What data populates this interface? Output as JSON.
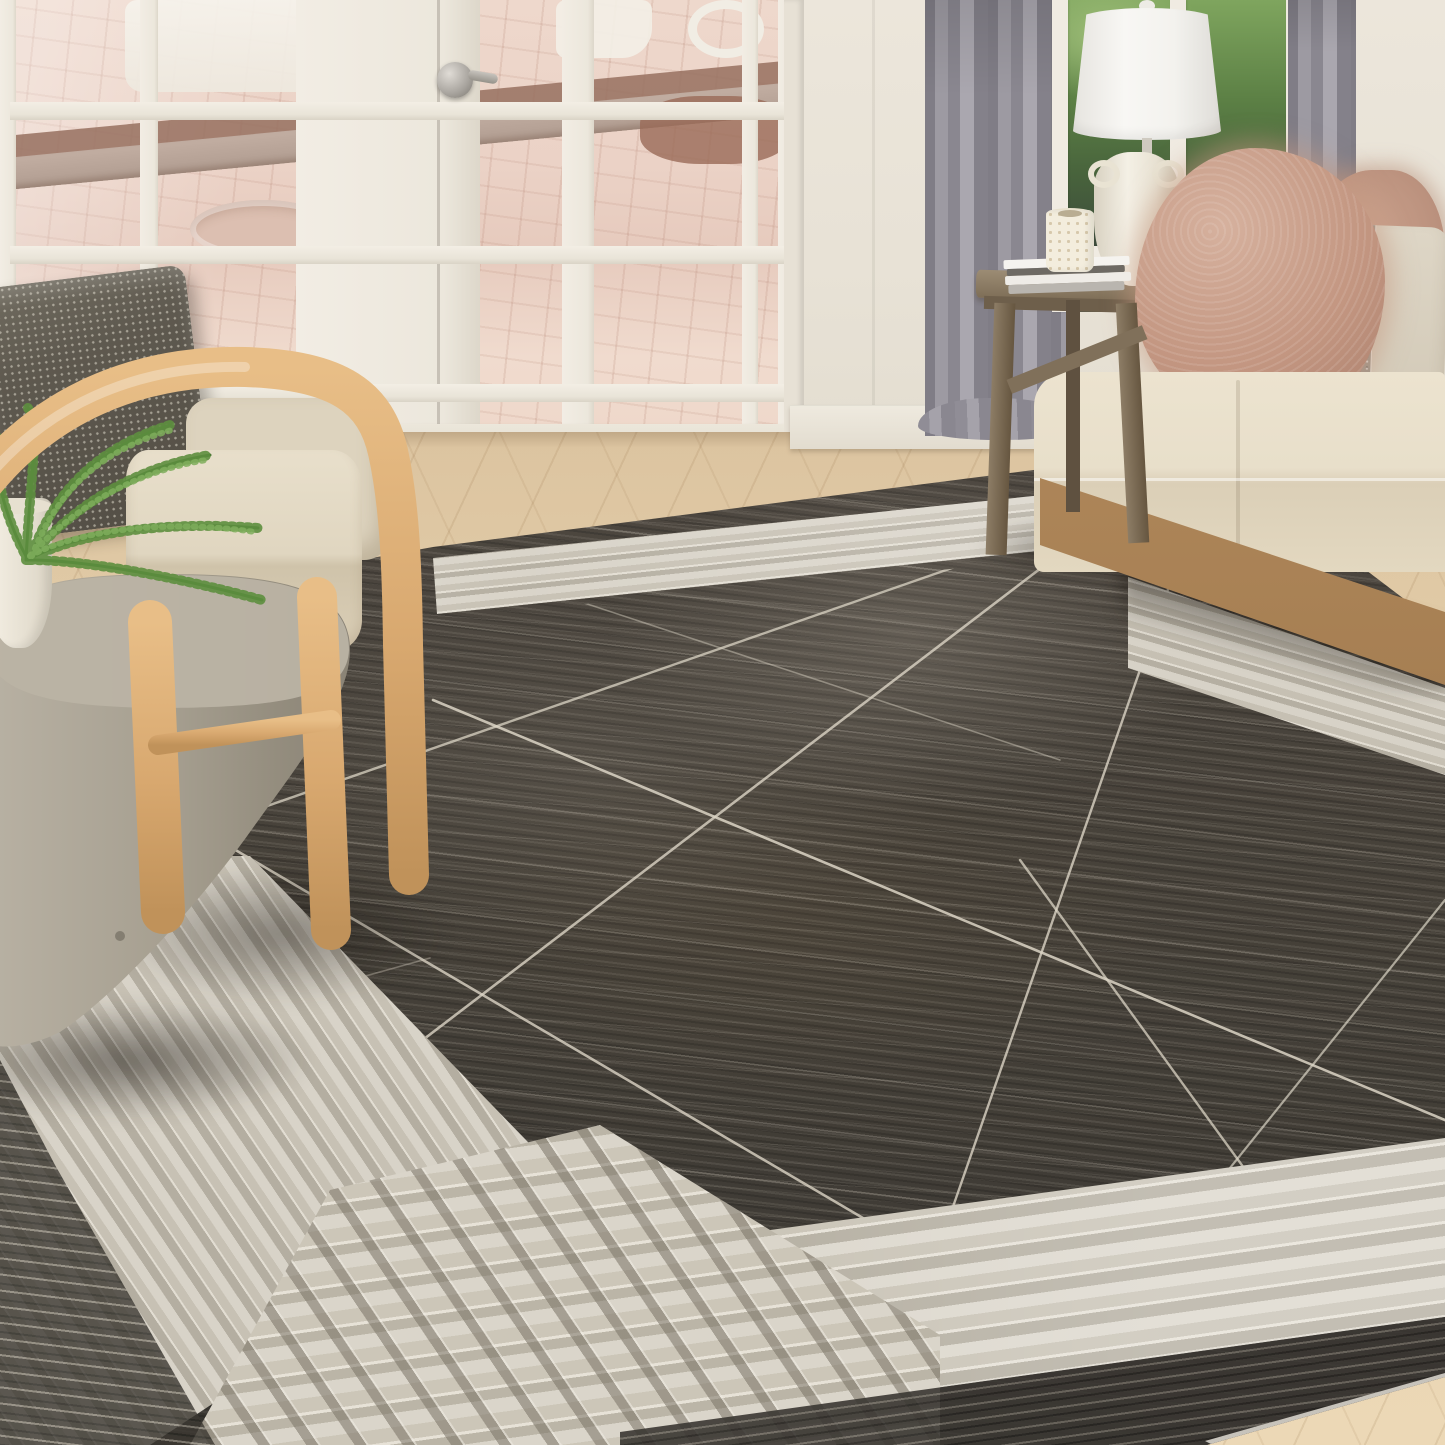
{
  "scene": {
    "label": "Living room scene featuring a charcoal modern area rug with thin ivory abstract lines and an ivory striped border, photographed with furniture",
    "objects": {
      "rug": {
        "label": "Charcoal area rug with ivory striped border, woven corner grid and thin abstract crossing lines"
      },
      "rug_field": {
        "label": "Charcoal rug field with distressed streaks"
      },
      "rug_border": {
        "label": "Ivory and silver striped rug border band"
      },
      "rug_corner": {
        "label": "Woven plaid corner of rug border"
      },
      "french_doors": {
        "label": "White french doors with glass panes showing brick patio"
      },
      "door_knob": {
        "label": "Satin nickel door knob with lever"
      },
      "patio": {
        "label": "Pink brick paver patio with white outdoor furniture and retaining wall"
      },
      "wall": {
        "label": "Cream painted wall"
      },
      "baseboard": {
        "label": "White baseboard trim"
      },
      "floor": {
        "label": "Light oak chevron wood floor"
      },
      "curtain_left": {
        "label": "Gray floor-length drapery panel"
      },
      "curtain_right": {
        "label": "Gray drapery panel beside window"
      },
      "window": {
        "label": "Window with green garden foliage"
      },
      "lamp": {
        "label": "White ceramic table lamp with drum shade"
      },
      "side_table": {
        "label": "Rustic gray-wood trestle side table"
      },
      "books": {
        "label": "Stack of white and gray books"
      },
      "candle": {
        "label": "Ivory pierced candle holder"
      },
      "sofa": {
        "label": "Beige upholstered sofa with light wood base"
      },
      "fur_pillow": {
        "label": "Blush mongolian fur throw pillow"
      },
      "accent_pillow": {
        "label": "Beige pillow with silver beaded band"
      },
      "armchair": {
        "label": "Light oak bentwood armchair with beige cushions"
      },
      "chair_pillow": {
        "label": "Charcoal shimmer throw pillow"
      },
      "pedestal_table": {
        "label": "Round gray concrete pedestal side table"
      },
      "fern": {
        "label": "Potted maidenhair fern"
      },
      "plant_pot": {
        "label": "White ceramic planter"
      }
    },
    "palette": {
      "wall": "#eae4d9",
      "door_frame": "#f0ebe2",
      "patio_brick": "#ebd2c6",
      "floor_wood": "#e4cfab",
      "curtain_gray": "#908d95",
      "greenery": "#537a3f",
      "lamp_white": "#f4f3ef",
      "sofa_fabric": "#e9e0cc",
      "sofa_wood": "#a37c50",
      "fur_pillow": "#c39681",
      "accent_pillow": "#d9d1c2",
      "sparkle_band": "#9b958a",
      "chair_wood": "#d9ab72",
      "chair_cushion": "#e3dac6",
      "chair_pillow": "#5b564c",
      "pedestal_concrete": "#aaa394",
      "fern_green": "#5c8a3e",
      "rug_field": "#49443d",
      "rug_line": "#dcd5c6",
      "rug_band_base": "#d8d3c8",
      "rug_band_stripe": "#b5afa2"
    }
  }
}
